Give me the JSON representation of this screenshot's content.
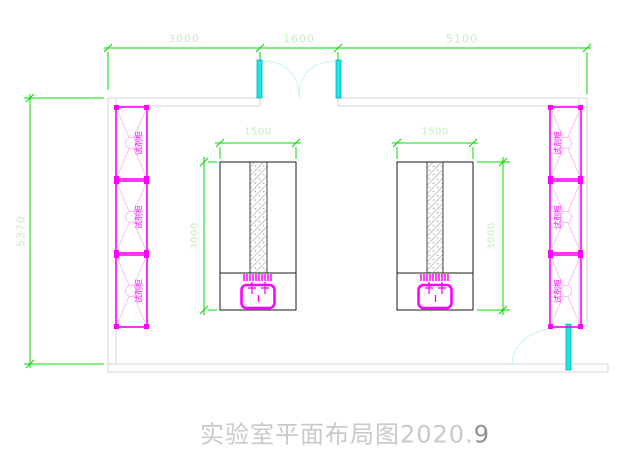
{
  "title": {
    "main": "实验室平面布局图2020.",
    "suffix": "9"
  },
  "dimensions": {
    "top_left": "3000",
    "top_middle": "1600",
    "top_right": "5100",
    "room_height": "5370",
    "bench_left_width": "1500",
    "bench_left_depth": "3000",
    "bench_right_width": "1500",
    "bench_right_depth": "3000"
  },
  "cabinets": {
    "left": [
      "试剂柜",
      "试剂柜",
      "试剂柜"
    ],
    "right": [
      "试剂柜",
      "试剂柜",
      "试剂柜"
    ]
  },
  "colors": {
    "dimension_green": "#00dc00",
    "dimension_text_green": "#c6edc0",
    "fixture_magenta": "#ff00ff",
    "door_cyan": "#1fe3e6",
    "wall_gray": "#d4d4d4"
  }
}
